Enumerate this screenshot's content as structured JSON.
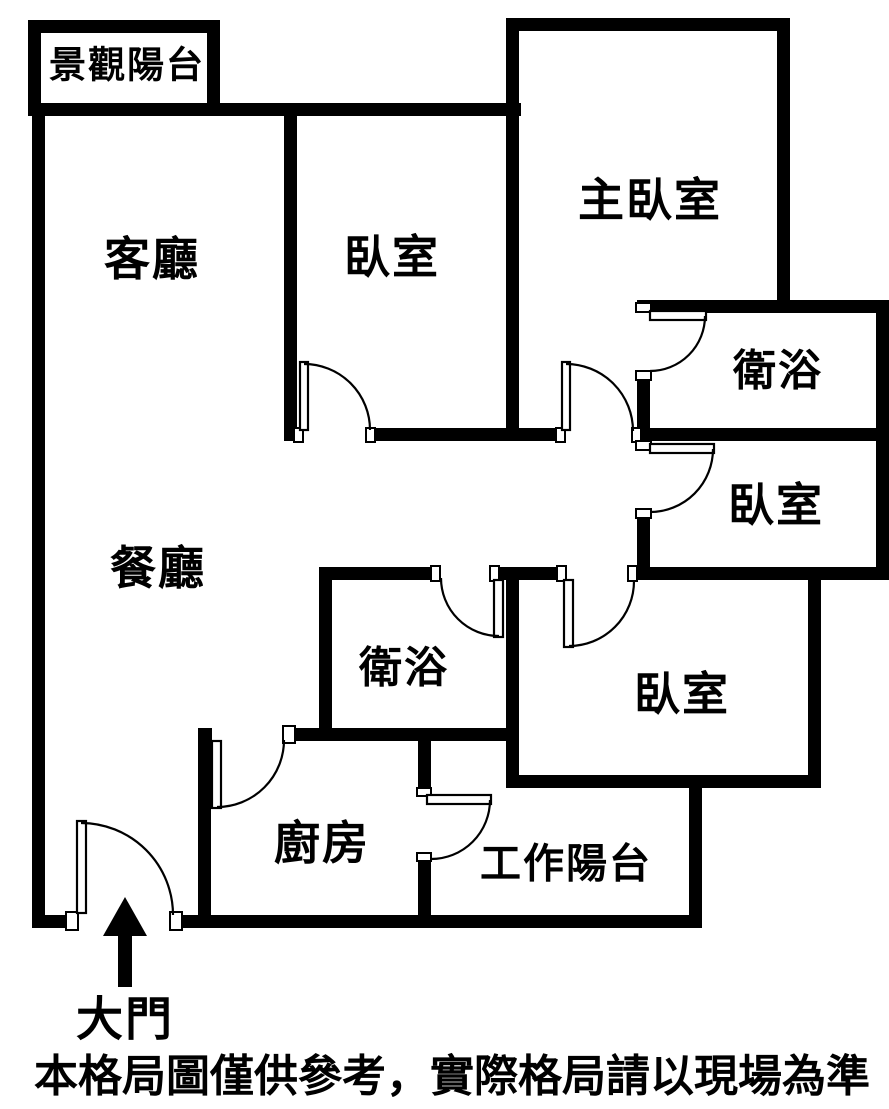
{
  "page": {
    "background_color": "#ffffff",
    "wall_color": "#000000",
    "text_color": "#000000"
  },
  "floorplan": {
    "rooms": [
      {
        "id": "view-balcony",
        "label": "景觀陽台"
      },
      {
        "id": "living-room",
        "label": "客廳"
      },
      {
        "id": "bedroom-top",
        "label": "臥室"
      },
      {
        "id": "master-bedroom",
        "label": "主臥室"
      },
      {
        "id": "bathroom-right",
        "label": "衛浴"
      },
      {
        "id": "bedroom-right",
        "label": "臥室"
      },
      {
        "id": "dining-room",
        "label": "餐廳"
      },
      {
        "id": "bathroom-middle",
        "label": "衛浴"
      },
      {
        "id": "bedroom-bottom-right",
        "label": "臥室"
      },
      {
        "id": "kitchen",
        "label": "廚房"
      },
      {
        "id": "work-balcony",
        "label": "工作陽台"
      }
    ],
    "entrance": {
      "label": "大門"
    },
    "caption": "本格局圖僅供參考，實際格局請以現場為準"
  }
}
